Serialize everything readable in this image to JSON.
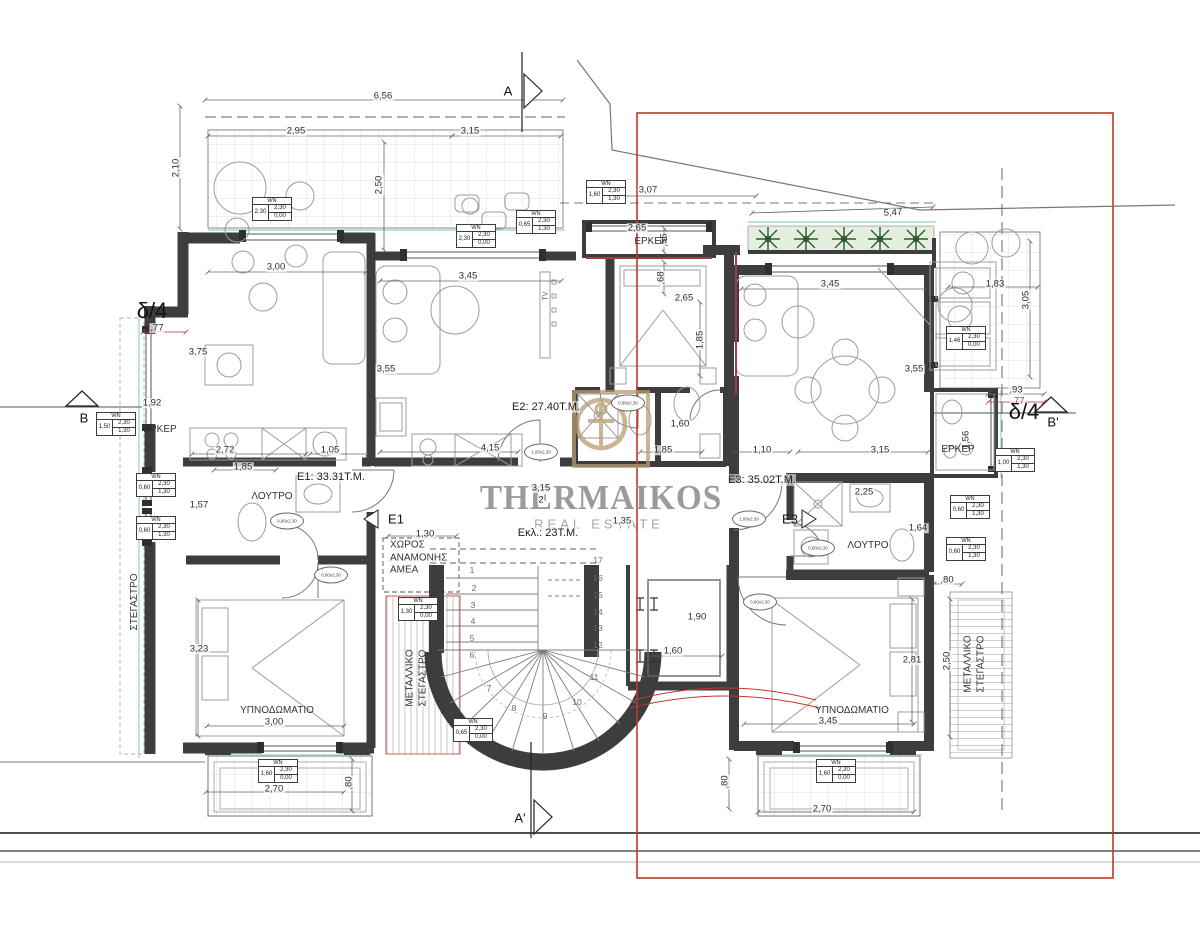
{
  "watermark": {
    "brand": "THERMAIKOS",
    "tagline": "REAL ESTATE"
  },
  "colors": {
    "overlay_red": "#c0392b",
    "wall": "#3d3d3d",
    "gold_logo": "#b79d74",
    "plant_green": "#2d5a2e",
    "cyan_outline": "#a8d5d5"
  },
  "plan": {
    "window_tag_header": "WN",
    "unit_labels": [
      {
        "t": "E1: 33.31Τ.Μ.",
        "x": 331,
        "y": 477
      },
      {
        "t": "E2: 27.40Τ.Μ.",
        "x": 546,
        "y": 407
      },
      {
        "t": "E3: 35.02Τ.Μ.",
        "x": 762,
        "y": 480
      },
      {
        "t": "Εκλ.: 23Τ.Μ.",
        "x": 548,
        "y": 533
      }
    ],
    "room_labels": [
      {
        "t": "ΕΡΚΕΡ",
        "x": 160,
        "y": 430
      },
      {
        "t": "ΕΡΚΕΡ",
        "x": 651,
        "y": 242
      },
      {
        "t": "ΕΡΚΕΡ",
        "x": 958,
        "y": 450
      },
      {
        "t": "ΛΟΥΤΡΟ",
        "x": 272,
        "y": 497
      },
      {
        "t": "ΛΟΥΤΡΟ",
        "x": 868,
        "y": 546
      },
      {
        "t": "ΥΠΝΟΔΩΜΑΤΙΟ",
        "x": 277,
        "y": 711
      },
      {
        "t": "ΥΠΝΟΔΩΜΑΤΙΟ",
        "x": 852,
        "y": 711
      },
      {
        "t": "ΣΤΕΓΑΣΤΡΟ",
        "x": 135,
        "y": 602,
        "r": -90
      },
      {
        "t": "ΜΕΤΑΛΛΙΚΟ\nΣΤΕΓΑΣΤΡΟ",
        "x": 417,
        "y": 678,
        "r": -90
      },
      {
        "t": "ΜΕΤΑΛΛΙΚΟ\nΣΤΕΓΑΣΤΡΟ",
        "x": 975,
        "y": 664,
        "r": -90
      },
      {
        "t": "ΧΩΡΟΣ\nΑΝΑΜΟΝΗΣ\nΑΜΕΑ",
        "x": 390,
        "y": 558,
        "c": "left"
      },
      {
        "t": "TV",
        "x": 547,
        "y": 296,
        "r": -90,
        "c": "tiny"
      }
    ],
    "section_markers": [
      {
        "t": "A",
        "x": 508,
        "y": 91
      },
      {
        "t": "A'",
        "x": 520,
        "y": 818
      },
      {
        "t": "B",
        "x": 84,
        "y": 418
      },
      {
        "t": "B'",
        "x": 1053,
        "y": 422
      },
      {
        "t": "δ/4",
        "x": 152,
        "y": 311,
        "c": "big"
      },
      {
        "t": "δ/4",
        "x": 1024,
        "y": 412,
        "c": "big"
      },
      {
        "t": "E1",
        "x": 396,
        "y": 519
      },
      {
        "t": "E3",
        "x": 790,
        "y": 519
      }
    ],
    "dimensions": [
      {
        "t": "6,56",
        "x": 383,
        "y": 96
      },
      {
        "t": "2,95",
        "x": 296,
        "y": 131
      },
      {
        "t": "3,15",
        "x": 470,
        "y": 131
      },
      {
        "t": "2,10",
        "x": 176,
        "y": 168,
        "r": -90
      },
      {
        "t": "2,50",
        "x": 379,
        "y": 185,
        "r": -90
      },
      {
        "t": "3,07",
        "x": 648,
        "y": 190
      },
      {
        "t": "5,47",
        "x": 893,
        "y": 213,
        "r": -3
      },
      {
        "t": "3,00",
        "x": 276,
        "y": 267
      },
      {
        "t": "3,45",
        "x": 468,
        "y": 276
      },
      {
        "t": "2,65",
        "x": 637,
        "y": 228
      },
      {
        "t": ",55",
        "x": 664,
        "y": 240,
        "r": -90
      },
      {
        "t": ",68",
        "x": 661,
        "y": 278,
        "r": -90
      },
      {
        "t": "2,65",
        "x": 684,
        "y": 298
      },
      {
        "t": "1,85",
        "x": 700,
        "y": 340,
        "r": -90
      },
      {
        "t": "3,45",
        "x": 830,
        "y": 284
      },
      {
        "t": "3,55",
        "x": 914,
        "y": 369
      },
      {
        "t": "1,83",
        "x": 995,
        "y": 284
      },
      {
        "t": "3,05",
        "x": 1026,
        "y": 300,
        "r": -90
      },
      {
        "t": ",93",
        "x": 1016,
        "y": 390
      },
      {
        "t": ",77",
        "x": 1018,
        "y": 401,
        "c": "red"
      },
      {
        "t": "1,56",
        "x": 966,
        "y": 440,
        "r": -90
      },
      {
        "t": "3,75",
        "x": 198,
        "y": 352
      },
      {
        "t": ",77",
        "x": 157,
        "y": 328
      },
      {
        "t": "1,92",
        "x": 152,
        "y": 403
      },
      {
        "t": "2,72",
        "x": 225,
        "y": 450
      },
      {
        "t": "1,05",
        "x": 330,
        "y": 450
      },
      {
        "t": "1,85",
        "x": 243,
        "y": 467
      },
      {
        "t": "1,57",
        "x": 199,
        "y": 505
      },
      {
        "t": "3,55",
        "x": 386,
        "y": 369
      },
      {
        "t": "4,15",
        "x": 490,
        "y": 448
      },
      {
        "t": "1,60",
        "x": 680,
        "y": 424
      },
      {
        "t": "1,85",
        "x": 663,
        "y": 450
      },
      {
        "t": "1,10",
        "x": 762,
        "y": 450
      },
      {
        "t": "3,15",
        "x": 880,
        "y": 450
      },
      {
        "t": "2,25",
        "x": 864,
        "y": 492
      },
      {
        "t": "1,64",
        "x": 918,
        "y": 528
      },
      {
        "t": "1,30",
        "x": 425,
        "y": 534
      },
      {
        "t": "3,15",
        "x": 541,
        "y": 488
      },
      {
        "t": "2",
        "x": 541,
        "y": 500
      },
      {
        "t": "1,35",
        "x": 622,
        "y": 521
      },
      {
        "t": "1,90",
        "x": 697,
        "y": 617
      },
      {
        "t": "1,60",
        "x": 673,
        "y": 651
      },
      {
        "t": "3,23",
        "x": 199,
        "y": 649
      },
      {
        "t": "3,00",
        "x": 274,
        "y": 722
      },
      {
        "t": "2,70",
        "x": 274,
        "y": 789
      },
      {
        "t": ",80",
        "x": 349,
        "y": 783,
        "r": -90
      },
      {
        "t": "2,81",
        "x": 912,
        "y": 660
      },
      {
        "t": "3,45",
        "x": 828,
        "y": 721
      },
      {
        "t": "2,70",
        "x": 822,
        "y": 809
      },
      {
        "t": ",80",
        "x": 725,
        "y": 782,
        "r": -90
      },
      {
        "t": ",80",
        "x": 947,
        "y": 580
      },
      {
        "t": "2,50",
        "x": 947,
        "y": 661,
        "r": -90
      }
    ],
    "window_tags": [
      {
        "x": 252,
        "y": 197,
        "w": "2,30",
        "h": "2,30",
        "s": "0,00"
      },
      {
        "x": 456,
        "y": 224,
        "w": "2,30",
        "h": "2,30",
        "s": "0,00"
      },
      {
        "x": 516,
        "y": 210,
        "w": "0,65",
        "h": "2,30",
        "s": "1,30"
      },
      {
        "x": 586,
        "y": 180,
        "w": "1,60",
        "h": "2,30",
        "s": "1,30"
      },
      {
        "x": 946,
        "y": 326,
        "w": "1,46",
        "h": "2,30",
        "s": "0,00"
      },
      {
        "x": 96,
        "y": 412,
        "w": "1,50",
        "h": "2,30",
        "s": "1,30"
      },
      {
        "x": 136,
        "y": 473,
        "w": "0,60",
        "h": "2,30",
        "s": "1,30"
      },
      {
        "x": 136,
        "y": 516,
        "w": "0,60",
        "h": "2,30",
        "s": "1,30"
      },
      {
        "x": 995,
        "y": 448,
        "w": "1,00",
        "h": "2,30",
        "s": "1,30"
      },
      {
        "x": 950,
        "y": 495,
        "w": "0,60",
        "h": "2,30",
        "s": "1,30"
      },
      {
        "x": 946,
        "y": 537,
        "w": "0,60",
        "h": "2,30",
        "s": "1,30"
      },
      {
        "x": 398,
        "y": 597,
        "w": "1,30",
        "h": "2,30",
        "s": "0,00"
      },
      {
        "x": 453,
        "y": 718,
        "w": "0,65",
        "h": "2,30",
        "s": "0,00"
      },
      {
        "x": 258,
        "y": 759,
        "w": "1,60",
        "h": "2,30",
        "s": "0,00"
      },
      {
        "x": 816,
        "y": 759,
        "w": "1,60",
        "h": "2,30",
        "s": "0,00"
      }
    ],
    "door_tags": [
      {
        "t": "0,90x2,30",
        "x": 287,
        "y": 521
      },
      {
        "t": "0,90x2,30",
        "x": 331,
        "y": 575
      },
      {
        "t": "1,00x2,30",
        "x": 541,
        "y": 452
      },
      {
        "t": "0,90x2,30",
        "x": 628,
        "y": 403
      },
      {
        "t": "1,00x2,30",
        "x": 749,
        "y": 519
      },
      {
        "t": "0,90x2,30",
        "x": 818,
        "y": 548
      },
      {
        "t": "0,90x2,30",
        "x": 760,
        "y": 602
      }
    ],
    "stair_steps": [
      {
        "t": "1",
        "x": 472,
        "y": 570
      },
      {
        "t": "2",
        "x": 474,
        "y": 588
      },
      {
        "t": "3",
        "x": 473,
        "y": 605
      },
      {
        "t": "4",
        "x": 473,
        "y": 621
      },
      {
        "t": "5",
        "x": 472,
        "y": 638
      },
      {
        "t": "6",
        "x": 472,
        "y": 655
      },
      {
        "t": "7",
        "x": 489,
        "y": 688
      },
      {
        "t": "8",
        "x": 514,
        "y": 708
      },
      {
        "t": "9",
        "x": 545,
        "y": 716
      },
      {
        "t": "10",
        "x": 577,
        "y": 702
      },
      {
        "t": "11",
        "x": 594,
        "y": 677
      },
      {
        "t": "12",
        "x": 598,
        "y": 645
      },
      {
        "t": "13",
        "x": 598,
        "y": 628
      },
      {
        "t": "14",
        "x": 598,
        "y": 612
      },
      {
        "t": "15",
        "x": 598,
        "y": 595
      },
      {
        "t": "16",
        "x": 598,
        "y": 578
      },
      {
        "t": "17",
        "x": 598,
        "y": 560
      }
    ]
  }
}
